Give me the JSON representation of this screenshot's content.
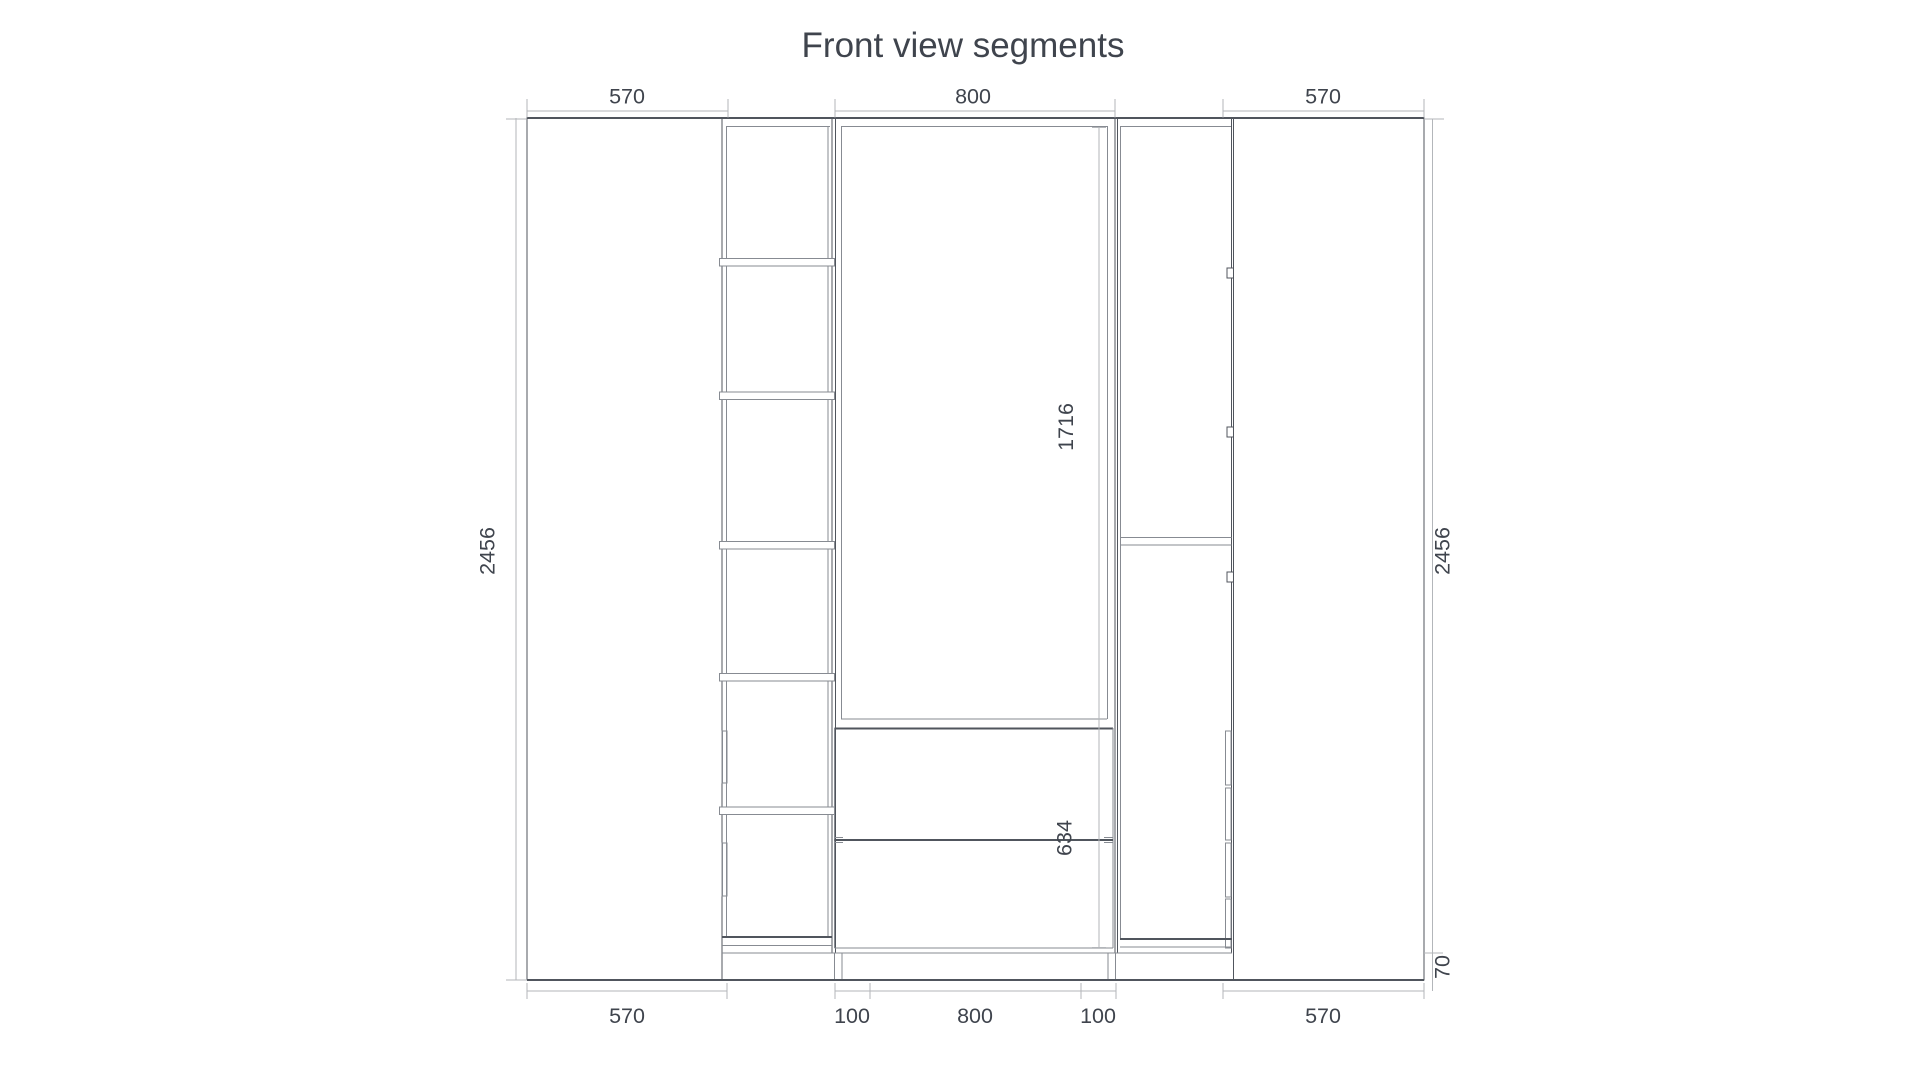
{
  "drawing": {
    "title": "Front view segments",
    "type": "furniture-front-elevation",
    "segments": [
      {
        "name": "left-tall-door",
        "width_mm": "570"
      },
      {
        "name": "open-shelf-column",
        "width_mm": "300",
        "shelf_cells": 6,
        "handles": 2
      },
      {
        "name": "middle-wardrobe",
        "width_mm": "800",
        "drawers": 2
      },
      {
        "name": "door-column-with-hinges",
        "width_mm": "300",
        "hinges": 3,
        "drawer_handles": 4
      },
      {
        "name": "right-tall-door",
        "width_mm": "570"
      }
    ]
  },
  "dimensions": {
    "top_left": "570",
    "top_middle": "800",
    "top_right": "570",
    "bottom_left": "570",
    "bottom_mid_left": "100",
    "bottom_middle": "800",
    "bottom_mid_right": "100",
    "bottom_right": "570",
    "height_left": "2456",
    "height_right": "2456",
    "opening_height": "1716",
    "drawer_section_height": "634",
    "plinth_height": "70"
  },
  "colors": {
    "line_dark": "#50555d",
    "line_mid": "#878b92",
    "line_dimension": "#b3b6ba",
    "text": "#3f444d",
    "background": "#ffffff"
  }
}
